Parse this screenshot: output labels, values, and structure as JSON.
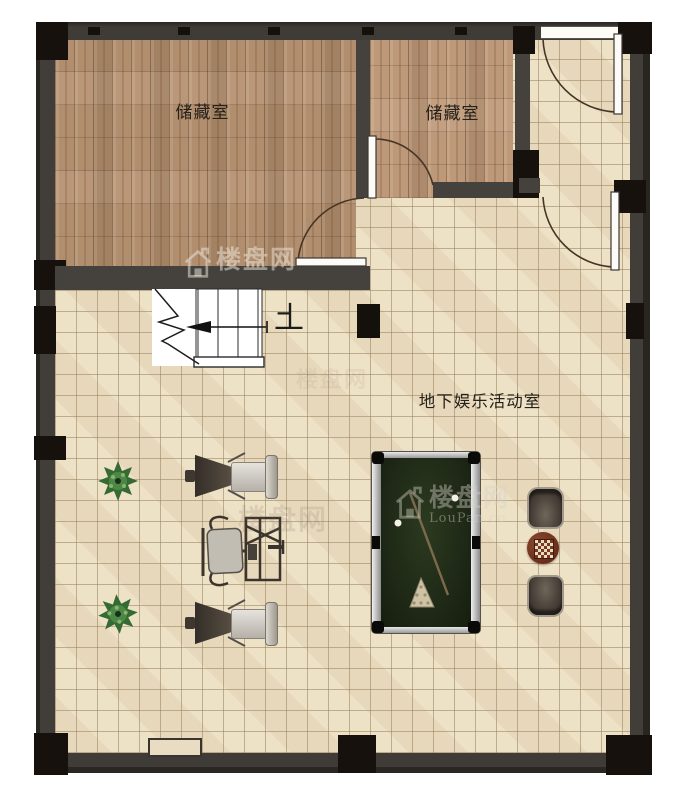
{
  "rooms": {
    "storage_left": {
      "label": "储藏室"
    },
    "storage_right": {
      "label": "储藏室"
    },
    "activity": {
      "label": "地下娱乐活动室"
    }
  },
  "stairs": {
    "direction_label": "上"
  },
  "watermarks": {
    "wall": {
      "text": "楼盘网"
    },
    "pool": {
      "text": "楼盘网",
      "subtext": "LouPan.co"
    },
    "gym": {
      "text": "楼盘网"
    },
    "ghost": {
      "text": "楼盘网"
    }
  },
  "colors": {
    "wall": "#3f3c38",
    "wall_black": "#16110d",
    "wood": "#b18e6e",
    "tile": "#ecdfc3",
    "felt": "#1f2916",
    "plant_green": "#3f7d3a",
    "chess_table": "#6b2d1a"
  }
}
